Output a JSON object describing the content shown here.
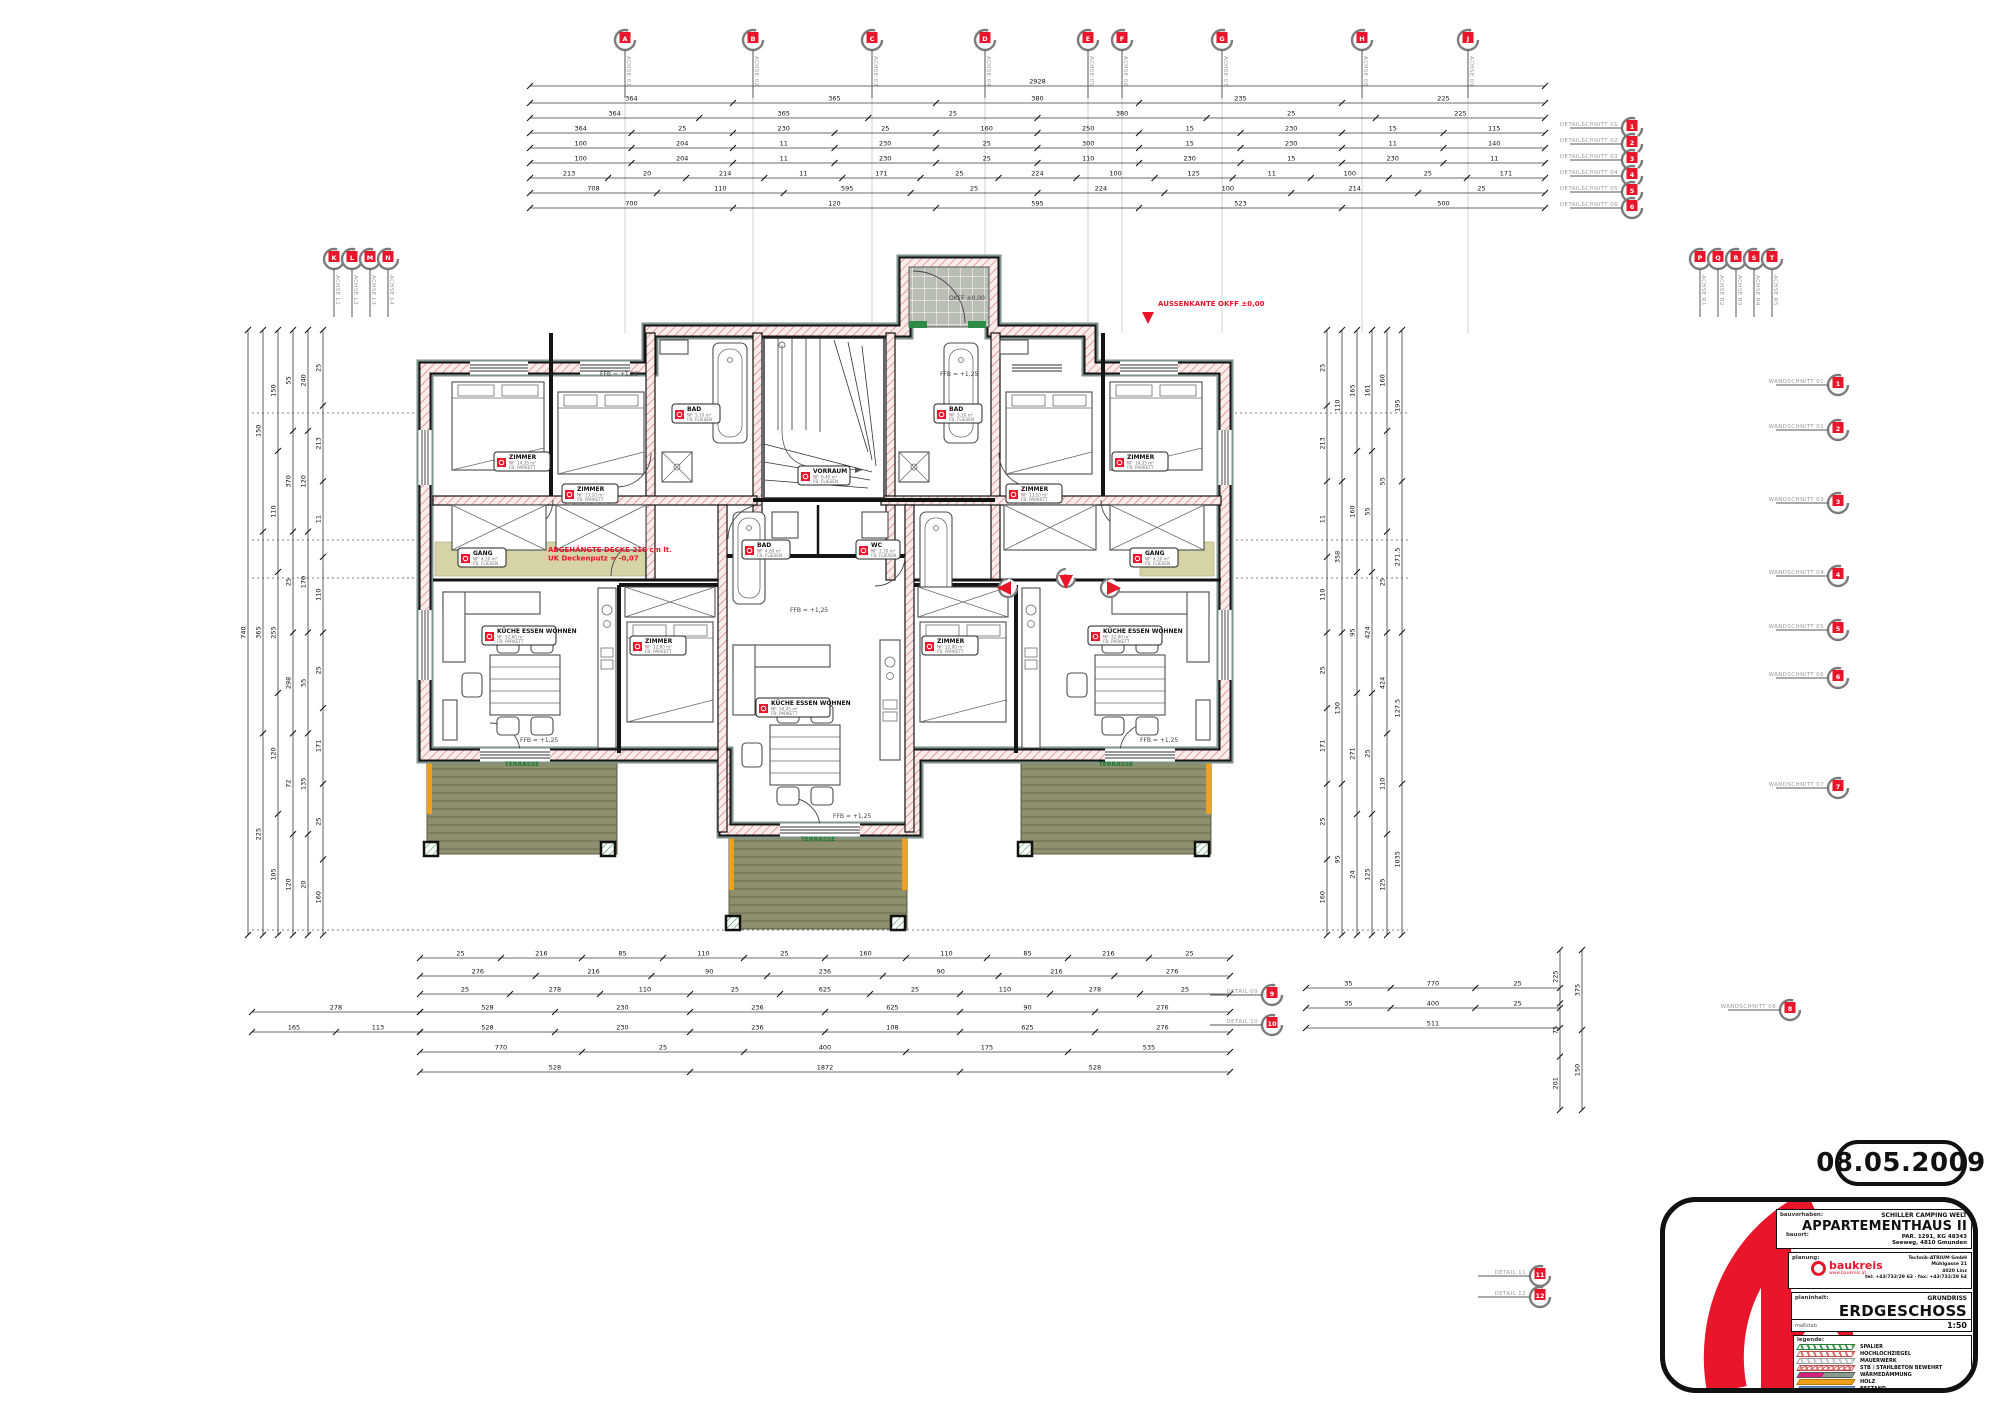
{
  "page": {
    "date_stamp": "08.05.2009"
  },
  "title_block": {
    "labels": {
      "bauvorhaben": "bauvorhaben:",
      "bauort": "bauort:",
      "planung": "planung:",
      "planinhalt": "planinhalt:",
      "legende": "legende:",
      "massstab": "maßstab"
    },
    "project_line": "SCHILLER CAMPING WELT",
    "title": "APPARTEMENTHAUS II",
    "parcel": "PAR. 1291, KG 48343",
    "address": "Seeweg, 4810 Gmunden",
    "planner": {
      "name": "baukreis",
      "web": "www.baukreis.at",
      "address_lines": [
        "Technik-ATRIUM GmbH",
        "Mühlgasse 21",
        "4020 Linz",
        "tel: +43/732/29 63 · fax: +43/732/29 64"
      ]
    },
    "content_small": "GRUNDRISS",
    "content_big": "ERDGESCHOSS",
    "scale": "1:50",
    "legend": [
      {
        "type": "hatch-green",
        "label": "SPALIER"
      },
      {
        "type": "hatch-red",
        "label": "HOCHLOCHZIEGEL"
      },
      {
        "type": "hatch-gray",
        "label": "MAUERWERK"
      },
      {
        "type": "cross-red",
        "label": "STB / STAHLBETON BEWEHRT"
      },
      {
        "type": "duo",
        "label": "WÄRMEDÄMMUNG"
      },
      {
        "type": "solid-orange",
        "label": "HOLZ"
      },
      {
        "type": "solid-blue",
        "label": "BESTAND"
      }
    ]
  },
  "plan": {
    "terrace_label": "TERRASSE",
    "red_notes": [
      {
        "x": 1158,
        "y": 306,
        "anchor": "start",
        "lines": [
          "AUSSENKANTE OKFF ±0,00"
        ]
      },
      {
        "x": 548,
        "y": 552,
        "anchor": "start",
        "lines": [
          "ABGEHÄNGTE DECKE 210 cm lt.",
          "UK Deckenputz = -0,07"
        ]
      }
    ],
    "floor_levels": [
      {
        "x": 600,
        "y": 376,
        "t": "FFB = +1,25"
      },
      {
        "x": 940,
        "y": 376,
        "t": "FFB = +1,25"
      },
      {
        "x": 790,
        "y": 612,
        "t": "FFB = +1,25"
      },
      {
        "x": 520,
        "y": 742,
        "t": "FFB = +1,25"
      },
      {
        "x": 833,
        "y": 818,
        "t": "FFB = +1,25"
      },
      {
        "x": 1140,
        "y": 742,
        "t": "FFB = +1,25"
      },
      {
        "x": 949,
        "y": 300,
        "t": "OKFF ±0,00"
      }
    ],
    "room_stamps": [
      {
        "x": 494,
        "y": 452,
        "w": 56,
        "label": "ZIMMER",
        "a": "NF: 14,35 m²",
        "b": "FB: PARKETT"
      },
      {
        "x": 562,
        "y": 484,
        "w": 56,
        "label": "ZIMMER",
        "a": "NF: 13,10 m²",
        "b": "FB: PARKETT"
      },
      {
        "x": 1006,
        "y": 484,
        "w": 56,
        "label": "ZIMMER",
        "a": "NF: 13,10 m²",
        "b": "FB: PARKETT"
      },
      {
        "x": 1112,
        "y": 452,
        "w": 56,
        "label": "ZIMMER",
        "a": "NF: 14,35 m²",
        "b": "FB: PARKETT"
      },
      {
        "x": 630,
        "y": 636,
        "w": 56,
        "label": "ZIMMER",
        "a": "NF: 12,80 m²",
        "b": "FB: PARKETT"
      },
      {
        "x": 922,
        "y": 636,
        "w": 56,
        "label": "ZIMMER",
        "a": "NF: 12,80 m²",
        "b": "FB: PARKETT"
      },
      {
        "x": 482,
        "y": 626,
        "w": 74,
        "label": "KÜCHE ESSEN WOHNEN",
        "a": "NF: 32,60 m²",
        "b": "FB: PARKETT"
      },
      {
        "x": 756,
        "y": 698,
        "w": 74,
        "label": "KÜCHE ESSEN WOHNEN",
        "a": "NF: 30,45 m²",
        "b": "FB: PARKETT"
      },
      {
        "x": 1088,
        "y": 626,
        "w": 74,
        "label": "KÜCHE ESSEN WOHNEN",
        "a": "NF: 32,60 m²",
        "b": "FB: PARKETT"
      },
      {
        "x": 672,
        "y": 404,
        "w": 48,
        "label": "BAD",
        "a": "NF: 5,10 m²",
        "b": "FB: FLIESEN"
      },
      {
        "x": 934,
        "y": 404,
        "w": 48,
        "label": "BAD",
        "a": "NF: 5,10 m²",
        "b": "FB: FLIESEN"
      },
      {
        "x": 742,
        "y": 540,
        "w": 48,
        "label": "BAD",
        "a": "NF: 4,80 m²",
        "b": "FB: FLIESEN"
      },
      {
        "x": 856,
        "y": 540,
        "w": 44,
        "label": "WC",
        "a": "NF: 2,10 m²",
        "b": "FB: FLIESEN"
      },
      {
        "x": 458,
        "y": 548,
        "w": 48,
        "label": "GANG",
        "a": "NF: 4,20 m²",
        "b": "FB: FLIESEN"
      },
      {
        "x": 1130,
        "y": 548,
        "w": 48,
        "label": "GANG",
        "a": "NF: 4,20 m²",
        "b": "FB: FLIESEN"
      },
      {
        "x": 798,
        "y": 466,
        "w": 52,
        "label": "VORRAUM",
        "a": "NF: 6,40 m²",
        "b": "FB: FLIESEN"
      }
    ],
    "section_markers": [
      {
        "x": 1008,
        "y": 588,
        "letter": "6",
        "arrow": "left"
      },
      {
        "x": 1066,
        "y": 578,
        "letter": "B",
        "arrow": "down"
      },
      {
        "x": 1110,
        "y": 588,
        "letter": "1",
        "arrow": "right"
      }
    ],
    "axis_markers": {
      "top": {
        "y": 40,
        "xs": [
          625,
          753,
          872,
          985,
          1088,
          1122,
          1222,
          1362,
          1468
        ],
        "letters": [
          "A",
          "B",
          "C",
          "D",
          "E",
          "F",
          "G",
          "H",
          "J"
        ],
        "labels": [
          "ACHSE 01",
          "ACHSE 02",
          "ACHSE 03",
          "ACHSE 04",
          "ACHSE 05",
          "ACHSE 06",
          "ACHSE 07",
          "ACHSE 08",
          "ACHSE 09"
        ]
      },
      "left_group": {
        "y": 259,
        "xs": [
          334,
          352,
          370,
          388
        ],
        "letters": [
          "K",
          "L",
          "M",
          "N"
        ],
        "labels": [
          "ACHSE L1",
          "ACHSE L2",
          "ACHSE L3",
          "ACHSE L4"
        ]
      },
      "right_group": {
        "y": 259,
        "xs": [
          1700,
          1718,
          1736,
          1754,
          1772
        ],
        "letters": [
          "P",
          "Q",
          "R",
          "S",
          "T"
        ],
        "labels": [
          "ACHSE R1",
          "ACHSE R2",
          "ACHSE R3",
          "ACHSE R4",
          "ACHSE R5"
        ]
      },
      "topright_col": {
        "x": 1632,
        "ys": [
          128,
          144,
          160,
          176,
          192,
          208
        ],
        "letters": [
          "1",
          "2",
          "3",
          "4",
          "5",
          "6"
        ],
        "labels": [
          "DETAILSCHNITT 01",
          "DETAILSCHNITT 02",
          "DETAILSCHNITT 03",
          "DETAILSCHNITT 04",
          "DETAILSCHNITT 05",
          "DETAILSCHNITT 06"
        ]
      },
      "right_col": {
        "x": 1838,
        "ys": [
          385,
          430,
          503,
          576,
          630,
          678,
          788
        ],
        "letters": [
          "1",
          "2",
          "3",
          "4",
          "5",
          "6",
          "7"
        ],
        "labels": [
          "WANDSCHNITT 01",
          "WANDSCHNITT 02",
          "WANDSCHNITT 03",
          "WANDSCHNITT 04",
          "WANDSCHNITT 05",
          "WANDSCHNITT 06",
          "WANDSCHNITT 07"
        ]
      },
      "singles": [
        {
          "x": 1790,
          "y": 1010,
          "letter": "8",
          "label": "WANDSCHNITT 08"
        },
        {
          "x": 1272,
          "y": 995,
          "letter": "9",
          "label": "DETAIL 09"
        },
        {
          "x": 1272,
          "y": 1025,
          "letter": "10",
          "label": "DETAIL 10"
        },
        {
          "x": 1540,
          "y": 1276,
          "letter": "11",
          "label": "DETAIL 11"
        },
        {
          "x": 1540,
          "y": 1297,
          "letter": "12",
          "label": "DETAIL 12"
        }
      ]
    },
    "dimension_chains": [
      {
        "o": "h",
        "y": 86,
        "x1": 530,
        "x2": 1545,
        "nums": [
          "2928"
        ]
      },
      {
        "o": "h",
        "y": 103,
        "x1": 530,
        "x2": 1545,
        "nums": [
          "364",
          "365",
          "380",
          "235",
          "225"
        ]
      },
      {
        "o": "h",
        "y": 118,
        "x1": 530,
        "x2": 1545,
        "nums": [
          "364",
          "365",
          "25",
          "380",
          "25",
          "225"
        ]
      },
      {
        "o": "h",
        "y": 133,
        "x1": 530,
        "x2": 1545,
        "nums": [
          "364",
          "25",
          "230",
          "25",
          "160",
          "250",
          "15",
          "230",
          "15",
          "115"
        ]
      },
      {
        "o": "h",
        "y": 148,
        "x1": 530,
        "x2": 1545,
        "nums": [
          "100",
          "204",
          "11",
          "230",
          "25",
          "300",
          "15",
          "230",
          "11",
          "140"
        ]
      },
      {
        "o": "h",
        "y": 163,
        "x1": 530,
        "x2": 1545,
        "nums": [
          "100",
          "204",
          "11",
          "230",
          "25",
          "110",
          "230",
          "15",
          "230",
          "11"
        ]
      },
      {
        "o": "h",
        "y": 178,
        "x1": 530,
        "x2": 1545,
        "nums": [
          "213",
          "20",
          "214",
          "11",
          "171",
          "25",
          "224",
          "100",
          "125",
          "11",
          "100",
          "25",
          "171"
        ]
      },
      {
        "o": "h",
        "y": 193,
        "x1": 530,
        "x2": 1545,
        "nums": [
          "708",
          "110",
          "595",
          "25",
          "224",
          "100",
          "214",
          "25"
        ]
      },
      {
        "o": "h",
        "y": 208,
        "x1": 530,
        "x2": 1545,
        "nums": [
          "700",
          "120",
          "595",
          "523",
          "500"
        ]
      },
      {
        "o": "h",
        "y": 958,
        "x1": 420,
        "x2": 1230,
        "nums": [
          "25",
          "216",
          "85",
          "110",
          "25",
          "160",
          "110",
          "85",
          "216",
          "25"
        ]
      },
      {
        "o": "h",
        "y": 976,
        "x1": 420,
        "x2": 1230,
        "nums": [
          "276",
          "216",
          "90",
          "236",
          "90",
          "216",
          "276"
        ]
      },
      {
        "o": "h",
        "y": 994,
        "x1": 420,
        "x2": 1230,
        "nums": [
          "25",
          "278",
          "110",
          "25",
          "625",
          "25",
          "110",
          "278",
          "25"
        ]
      },
      {
        "o": "h",
        "y": 1012,
        "x1": 420,
        "x2": 1230,
        "nums": [
          "528",
          "230",
          "236",
          "625",
          "90",
          "276"
        ]
      },
      {
        "o": "h",
        "y": 1032,
        "x1": 420,
        "x2": 1230,
        "nums": [
          "528",
          "230",
          "236",
          "108",
          "625",
          "276"
        ]
      },
      {
        "o": "h",
        "y": 1052,
        "x1": 420,
        "x2": 1230,
        "nums": [
          "770",
          "25",
          "400",
          "175",
          "535"
        ]
      },
      {
        "o": "h",
        "y": 1072,
        "x1": 420,
        "x2": 1230,
        "nums": [
          "528",
          "1872",
          "528"
        ]
      },
      {
        "o": "h",
        "y": 1012,
        "x1": 252,
        "x2": 420,
        "nums": [
          "278"
        ]
      },
      {
        "o": "h",
        "y": 1032,
        "x1": 252,
        "x2": 420,
        "nums": [
          "165",
          "113"
        ]
      },
      {
        "o": "h",
        "y": 988,
        "x1": 1306,
        "x2": 1560,
        "nums": [
          "35",
          "770",
          "25"
        ]
      },
      {
        "o": "h",
        "y": 1008,
        "x1": 1306,
        "x2": 1560,
        "nums": [
          "35",
          "400",
          "25"
        ]
      },
      {
        "o": "h",
        "y": 1028,
        "x1": 1306,
        "x2": 1560,
        "nums": [
          "511"
        ]
      },
      {
        "o": "v",
        "x": 248,
        "y1": 330,
        "y2": 935,
        "nums": [
          "740"
        ]
      },
      {
        "o": "v",
        "x": 263,
        "y1": 330,
        "y2": 935,
        "nums": [
          "150",
          "365",
          "225"
        ]
      },
      {
        "o": "v",
        "x": 278,
        "y1": 330,
        "y2": 935,
        "nums": [
          "150",
          "110",
          "255",
          "120",
          "105"
        ]
      },
      {
        "o": "v",
        "x": 293,
        "y1": 330,
        "y2": 935,
        "nums": [
          "55",
          "370",
          "25",
          "298",
          "72",
          "120"
        ]
      },
      {
        "o": "v",
        "x": 308,
        "y1": 330,
        "y2": 935,
        "nums": [
          "240",
          "120",
          "170",
          "55",
          "135",
          "20"
        ]
      },
      {
        "o": "v",
        "x": 323,
        "y1": 330,
        "y2": 935,
        "nums": [
          "25",
          "213",
          "11",
          "110",
          "25",
          "171",
          "25",
          "160"
        ]
      },
      {
        "o": "v",
        "x": 1327,
        "y1": 330,
        "y2": 935,
        "nums": [
          "25",
          "213",
          "11",
          "110",
          "25",
          "171",
          "25",
          "160"
        ]
      },
      {
        "o": "v",
        "x": 1342,
        "y1": 330,
        "y2": 935,
        "nums": [
          "110",
          "358",
          "130",
          "95"
        ]
      },
      {
        "o": "v",
        "x": 1357,
        "y1": 330,
        "y2": 935,
        "nums": [
          "165",
          "160",
          "95",
          "271",
          "24"
        ]
      },
      {
        "o": "v",
        "x": 1372,
        "y1": 330,
        "y2": 935,
        "nums": [
          "161",
          "55",
          "424",
          "25",
          "125"
        ]
      },
      {
        "o": "v",
        "x": 1387,
        "y1": 330,
        "y2": 935,
        "nums": [
          "160",
          "55",
          "25",
          "424",
          "110",
          "125"
        ]
      },
      {
        "o": "v",
        "x": 1402,
        "y1": 330,
        "y2": 935,
        "nums": [
          "195",
          "271.5",
          "127.5",
          "1035"
        ]
      },
      {
        "o": "v",
        "x": 1560,
        "y1": 950,
        "y2": 1110,
        "nums": [
          "225",
          "75",
          "201"
        ]
      },
      {
        "o": "v",
        "x": 1582,
        "y1": 950,
        "y2": 1110,
        "nums": [
          "375",
          "150"
        ]
      }
    ]
  }
}
